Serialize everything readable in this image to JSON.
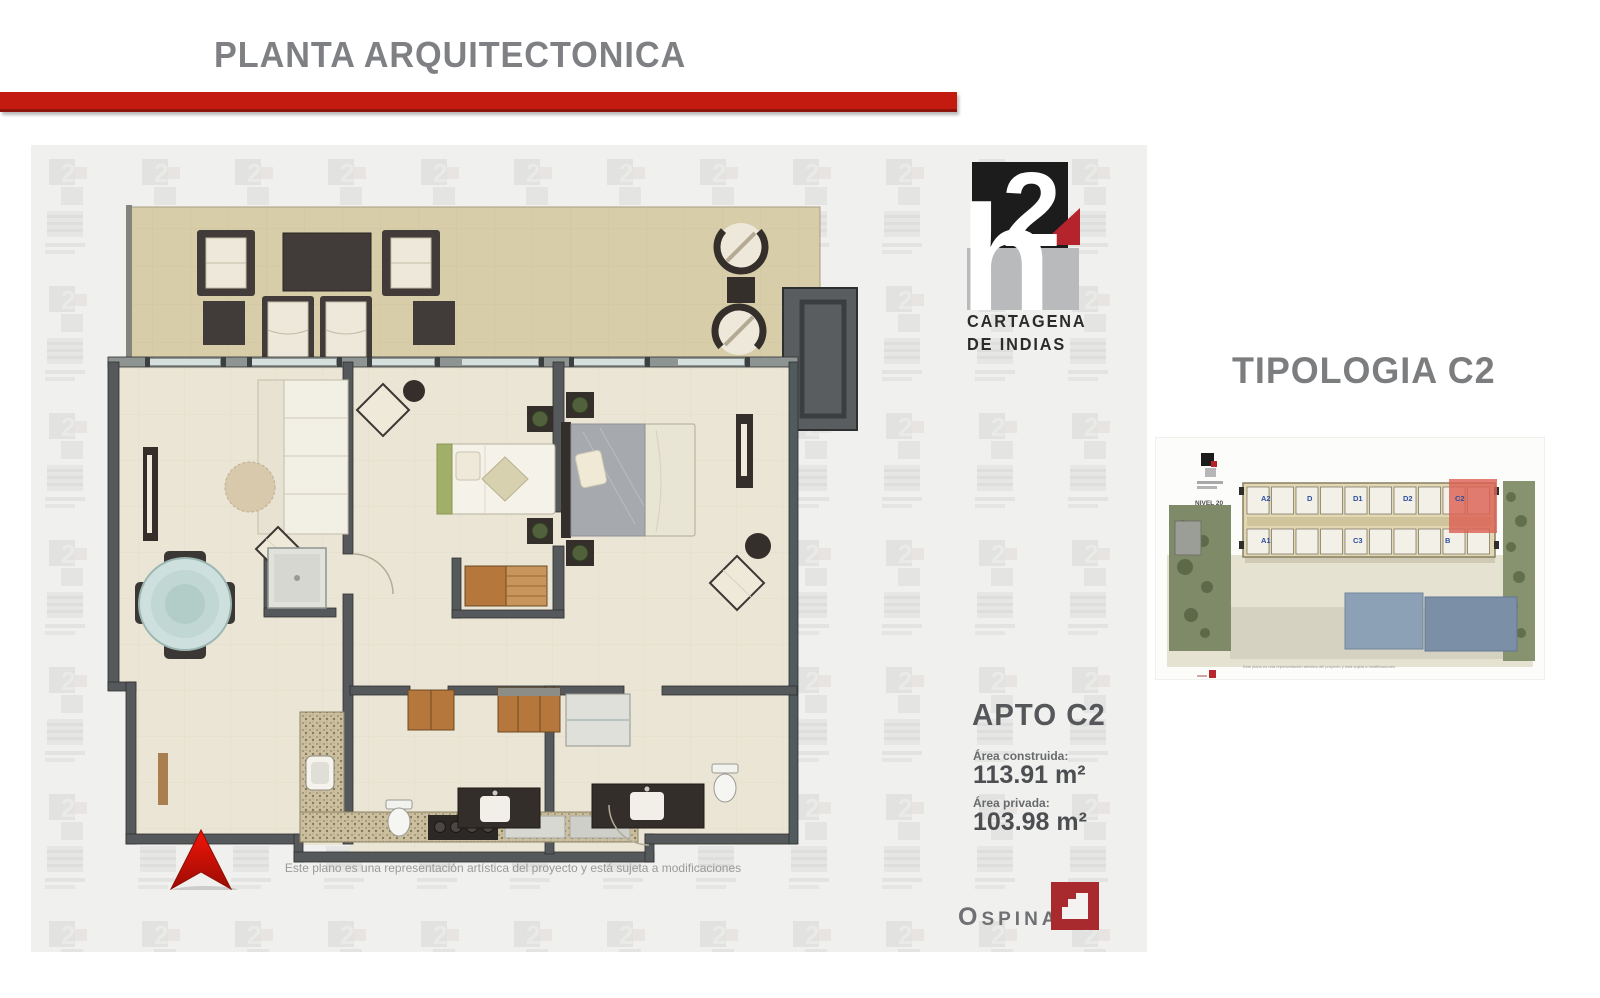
{
  "slide": {
    "title": "PLANTA ARQUITECTONICA"
  },
  "brand": {
    "h": "h",
    "two": "2",
    "city_line1": "CARTAGENA",
    "city_line2": "DE INDIAS"
  },
  "typology": {
    "title": "TIPOLOGIA C2"
  },
  "apartment": {
    "name": "APTO C2",
    "built_area_label": "Área construida:",
    "built_area_value": "113.91 m²",
    "private_area_label": "Área privada:",
    "private_area_value": "103.98 m²"
  },
  "floorplan": {
    "disclaimer": "Este plano es una representación artística del proyecto y está sujeta a modificaciones"
  },
  "site_plan": {
    "level_label": "NIVEL 20",
    "units_top": [
      "A2",
      "D",
      "D1",
      "D2",
      "C2"
    ],
    "units_bottom": [
      "A1",
      "C3",
      "B"
    ],
    "highlighted_unit": "C2",
    "caption": "Este plano es una representación artística del proyecto y está sujeta a modificaciones"
  },
  "developer": {
    "name": "OSPINAS"
  },
  "colors": {
    "accent_red": "#c41b10",
    "logo_red": "#b5242c",
    "logo_black": "#1c1c1c",
    "logo_gray": "#b9babc",
    "wall_gray": "#56595b",
    "terrace_tan": "#d8cda9",
    "floor_cream": "#ebe5d5",
    "highlight_salmon": "#dc6154",
    "title_gray": "#7e8083",
    "north_arrow_red": "#e01408"
  }
}
